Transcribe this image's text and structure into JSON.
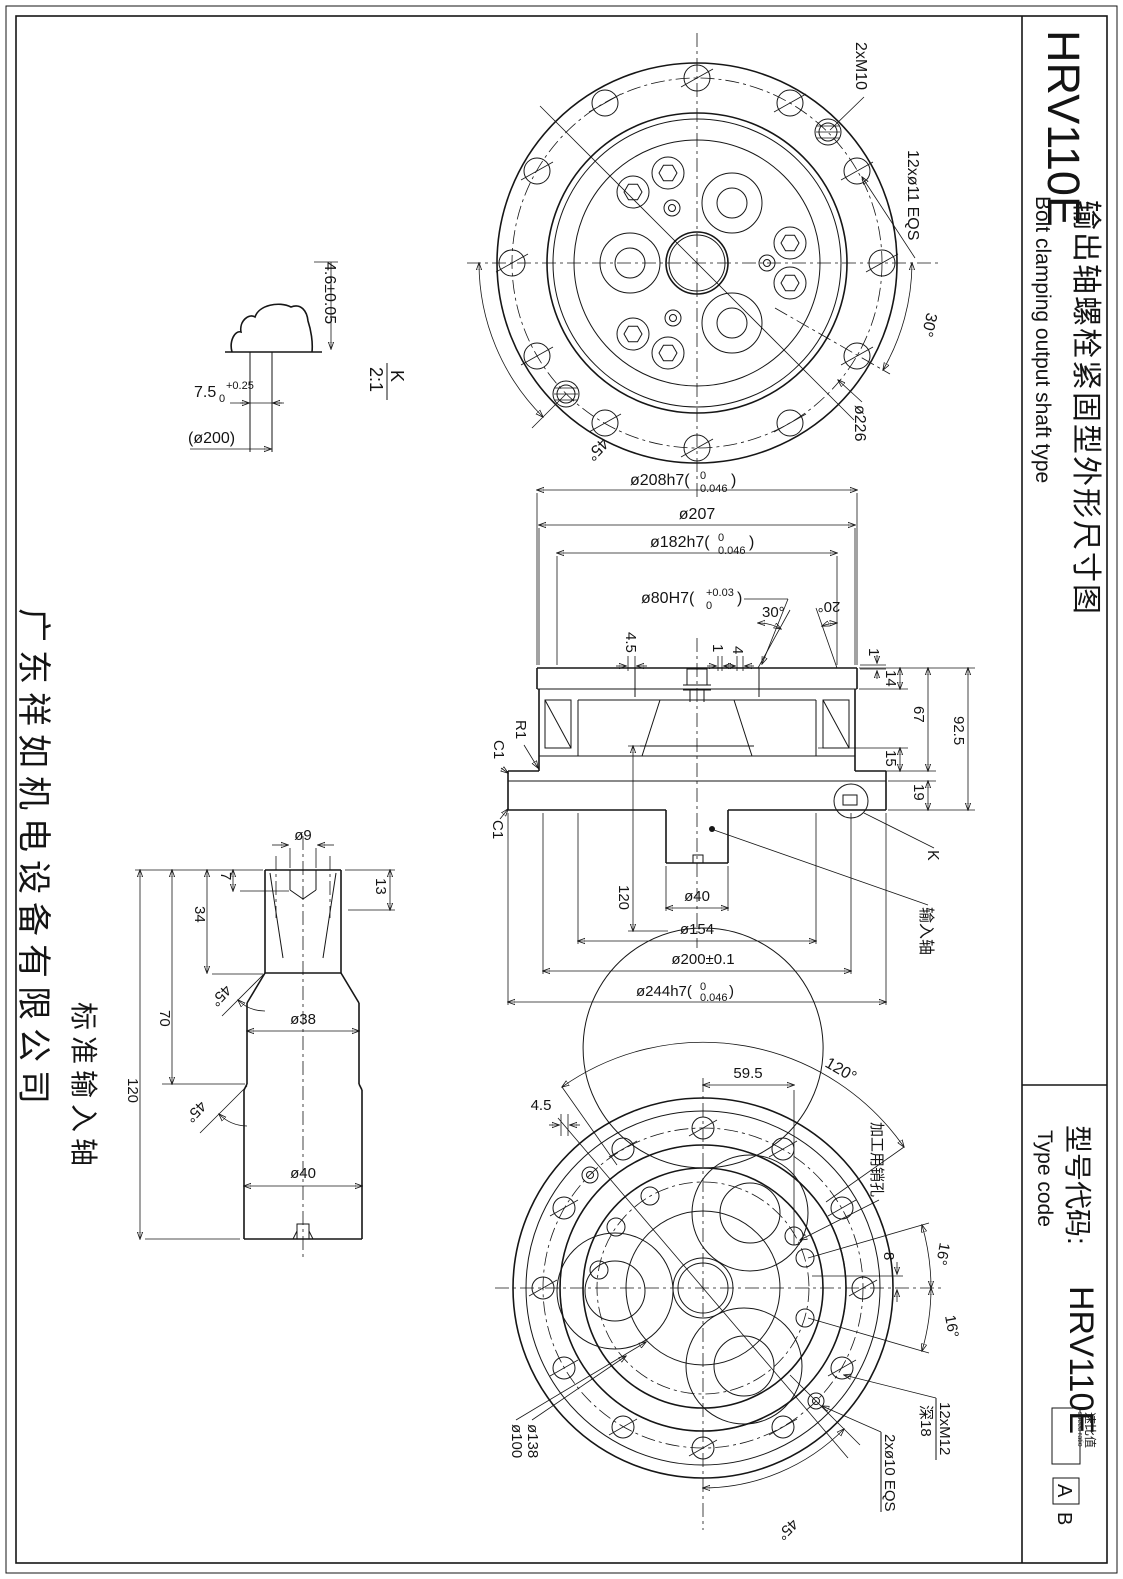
{
  "sheet": {
    "company": "广东祥如机电设备有限公司",
    "title": {
      "model": "HRV110E",
      "cn": "输出轴螺栓紧固型外形尺寸图",
      "en": "Bolt clamping output shaft type"
    },
    "type_code": {
      "label_cn": "型号代码:",
      "label_en": "Type code",
      "model": "HRV110E",
      "speed_ratio_cn": "速比值",
      "speed_ratio_en": "speed ratio",
      "suffix_a": "A",
      "suffix_b": "B"
    }
  },
  "front_view": {
    "bolt_note": "2xM10",
    "hole_note": "12xø11 EQS",
    "angle_pitch": "30°",
    "bolt_circle_dia": "ø226",
    "angle_m10": "45°"
  },
  "detail_k": {
    "height": "4.6±0.05",
    "slot_base": "7.5",
    "slot_sub": "0",
    "slot_sup": "+0.25",
    "ref_dia": "(ø200)",
    "label": "K",
    "scale": "2:1"
  },
  "section_view": {
    "dia_208_base": "ø208h7(",
    "dia_208_up": "0",
    "dia_208_low": "0.046",
    "paren": ")",
    "dia_207": "ø207",
    "dia_182_base": "ø182h7(",
    "dia_182_up": "0",
    "dia_182_low": "0.046",
    "dia_80_base": "ø80H7(",
    "dia_80_up": "+0.03",
    "dia_80_low": "0",
    "angle_30": "30°",
    "angle_20": "20°",
    "dim_4_5": "4.5",
    "dim_1_left": "1",
    "dim_4": "4",
    "dim_1_right": "1",
    "dim_14": "14",
    "dim_67": "67",
    "dim_92_5": "92.5",
    "dim_15": "15",
    "dim_19": "19",
    "fillet_r1": "R1",
    "chamfer_c1_top": "C1",
    "chamfer_c1_bottom": "C1",
    "dim_120": "120",
    "dia_40": "ø40",
    "dia_154": "ø154",
    "dia_200": "ø200±0.1",
    "dia_244_base": "ø244h7(",
    "dia_244_up": "0",
    "dia_244_low": "0.046",
    "detail_ref": "K",
    "input_shaft_ref": "输入轴"
  },
  "input_shaft": {
    "label": "标准输入轴",
    "dia_9": "ø9",
    "dim_7": "7",
    "dim_13": "13",
    "dim_34": "34",
    "dim_70": "70",
    "dim_120": "120",
    "chamfer_top": "45°",
    "dia_38": "ø38",
    "chamfer_bottom": "45°",
    "dia_40": "ø40"
  },
  "rear_view": {
    "dim_59_5": "59.5",
    "dim_4_5": "4.5",
    "angle_120": "120°",
    "pin_hole_note": "加工用销孔",
    "dim_8": "8",
    "angle_16_upper": "16°",
    "angle_16_lower": "16°",
    "tap_note": "12xM12",
    "tap_depth": "深18",
    "pin_note": "2xø10 EQS",
    "angle_45": "45°",
    "dia_138": "ø138",
    "dia_100": "ø100"
  }
}
